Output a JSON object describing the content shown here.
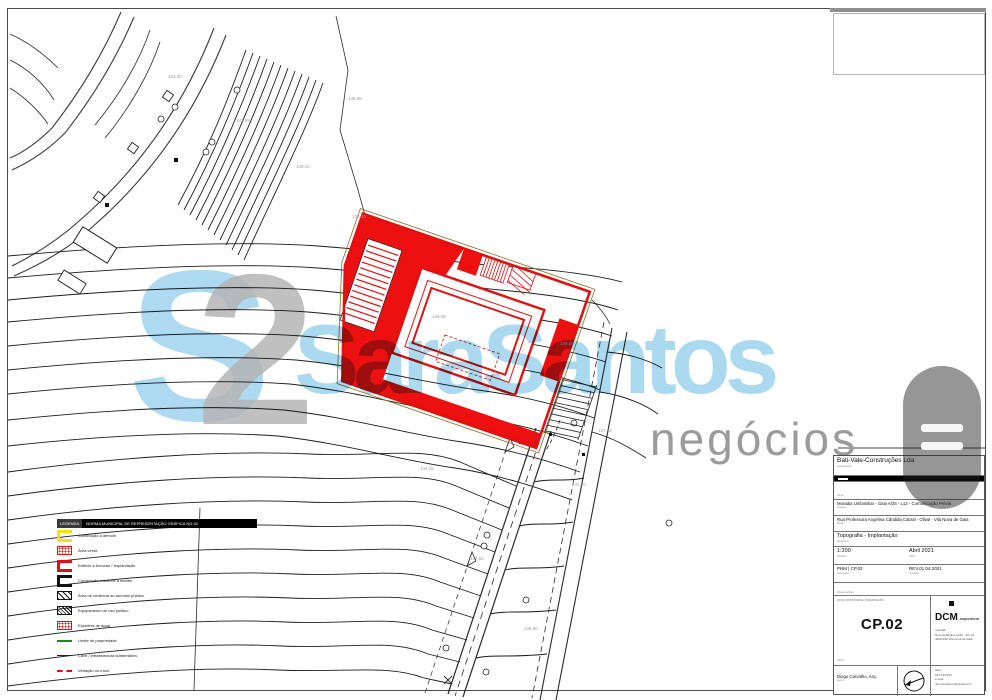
{
  "watermark": {
    "monogram_s": "S",
    "monogram_2": "2",
    "name": "SaraSantos",
    "tagline": "negócios",
    "blue": "#a7d7ef",
    "gray": "#9b9b9b"
  },
  "title_block": {
    "company": "Bati-Vale-Construções Lda",
    "company_label": "requerente",
    "obra_label": "obra",
    "project": "Moradia Unifamiliar - Gaia A/26 - L13 - Comunicação Prévia",
    "project_label": "projeto",
    "address": "Rua Professora Angelina Cândida Cabral - Olival - Vila Nova de Gaia",
    "address_label": "local",
    "drawing": "Topografia - Implantação",
    "drawing_label": "desenho",
    "scale": "1:200",
    "scale_label": "escala",
    "date": "Abril 2021",
    "date_label": "data",
    "process": "PHM | CP.02",
    "process_label": "processo",
    "revision": "REV.01 04.2021",
    "revision_label": "revisão",
    "notes_label": "observações",
    "piece_label": "peça desenhada, implantação",
    "piece_sublabel": "folha",
    "sheet_number": "CP.02",
    "architect": {
      "logo": "DCM",
      "logo_suffix": "_ARQUITECTO",
      "name": "Diogo Carvalho, Arq.",
      "name_label": "autor",
      "address_lines_0": "morada:",
      "address_lines_1": "Rua da Bélgica 3434 - S/L 24",
      "address_lines_2": "4400-209 Vila Nova de Gaia",
      "contact_lines_0": "telef:",
      "contact_lines_1": "223 743 684",
      "contact_lines_2": "e-mail:",
      "contact_lines_3": "dcm.arquitecto@gmail.com"
    }
  },
  "legend": {
    "prefix": "LEGENDA",
    "header": "NORMA MUNICIPAL DE REPRESENTAÇÃO GRÁFICA NG-01",
    "items": [
      {
        "label": "Construção a demolir"
      },
      {
        "label": "Área verde"
      },
      {
        "label": "Edifício a licenciar / Implantação"
      },
      {
        "label": "Construção existente a manter"
      },
      {
        "label": "Área de cedência ao domínio público"
      },
      {
        "label": "Equipamento de uso público"
      },
      {
        "label": "Espelhos de água"
      },
      {
        "label": "Limite de propriedade"
      },
      {
        "label": "Cave / infraestrutura subterrânea"
      },
      {
        "label": "Vedação ou muro"
      }
    ]
  },
  "drawing": {
    "accent_red": "#e01111",
    "line_color": "#2a2a2a",
    "spot_elevations": [
      "148.56",
      "149.55",
      "146.10",
      "143.89",
      "151.30",
      "139.80",
      "137.45",
      "141.20",
      "135.60",
      "147.52",
      "144.15",
      "138.30"
    ]
  }
}
